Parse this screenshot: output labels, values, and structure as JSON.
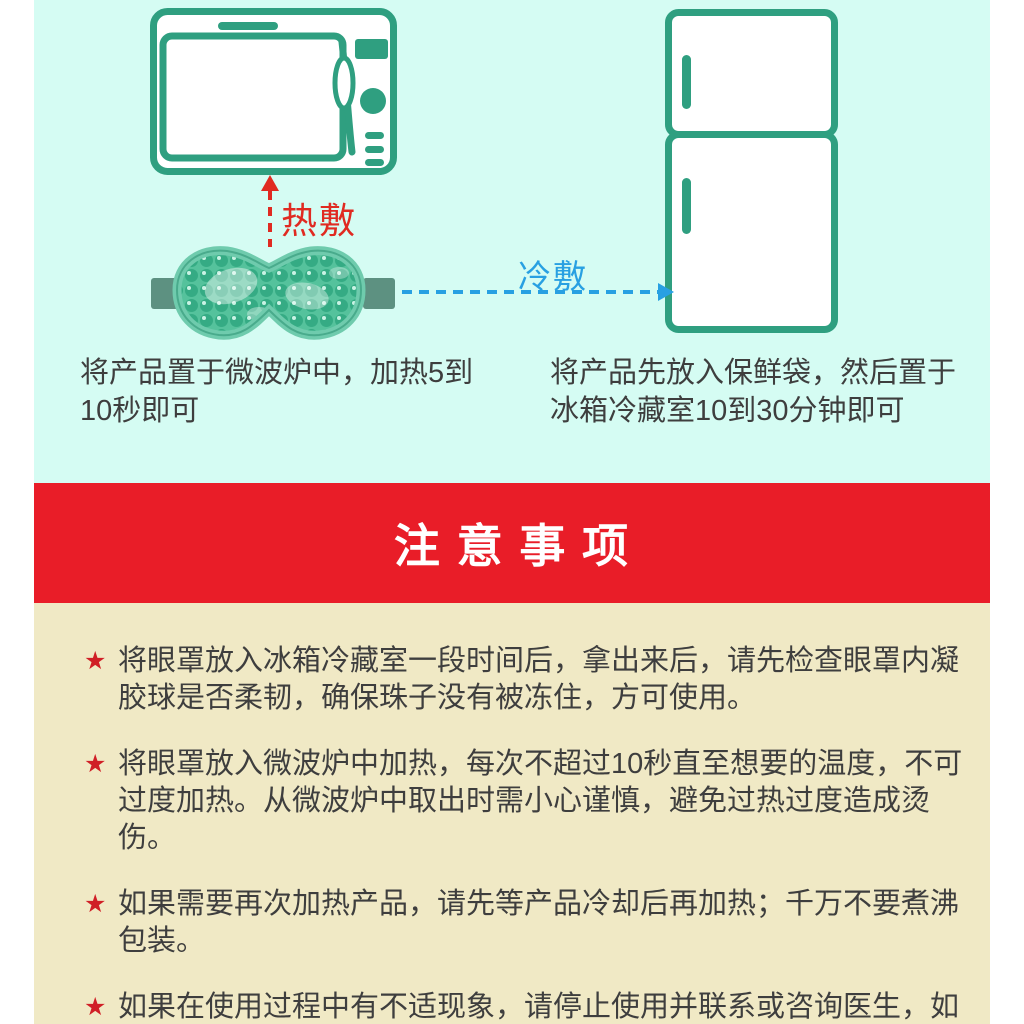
{
  "theme": {
    "mint": "#d5fcf3",
    "teal": "#2f9f80",
    "bannerred": "#e91d28",
    "hotred": "#e02a21",
    "coldblue": "#28a0e2",
    "cream": "#f0e9c5",
    "text": "#3e3e3e",
    "starred": "#d01f26"
  },
  "icons": {
    "microwave": "microwave-icon",
    "refrigerator": "refrigerator-icon",
    "eye_mask": "gel-bead-eye-mask-illustration"
  },
  "usage": {
    "hot_label": "热敷",
    "cold_label": "冷敷",
    "microwave_caption": "将产品置于微波炉中，加热5到10秒即可",
    "fridge_caption": "将产品先放入保鲜袋，然后置于冰箱冷藏室10到30分钟即可"
  },
  "banner": {
    "title": "注 意 事 项"
  },
  "precautions": {
    "bullet": "★",
    "items": [
      "将眼罩放入冰箱冷藏室一段时间后，拿出来后，请先检查眼罩内凝胶球是否柔韧，确保珠子没有被冻住，方可使用。",
      "将眼罩放入微波炉中加热，每次不超过10秒直至想要的温度，不可过度加热。从微波炉中取出时需小心谨慎，避免过热过度造成烫伤。",
      "如果需要再次加热产品，请先等产品冷却后再加热；千万不要煮沸包装。",
      "如果在使用过程中有不适现象，请停止使用并联系或咨询医生，如果有破损则请停止使用。"
    ]
  }
}
